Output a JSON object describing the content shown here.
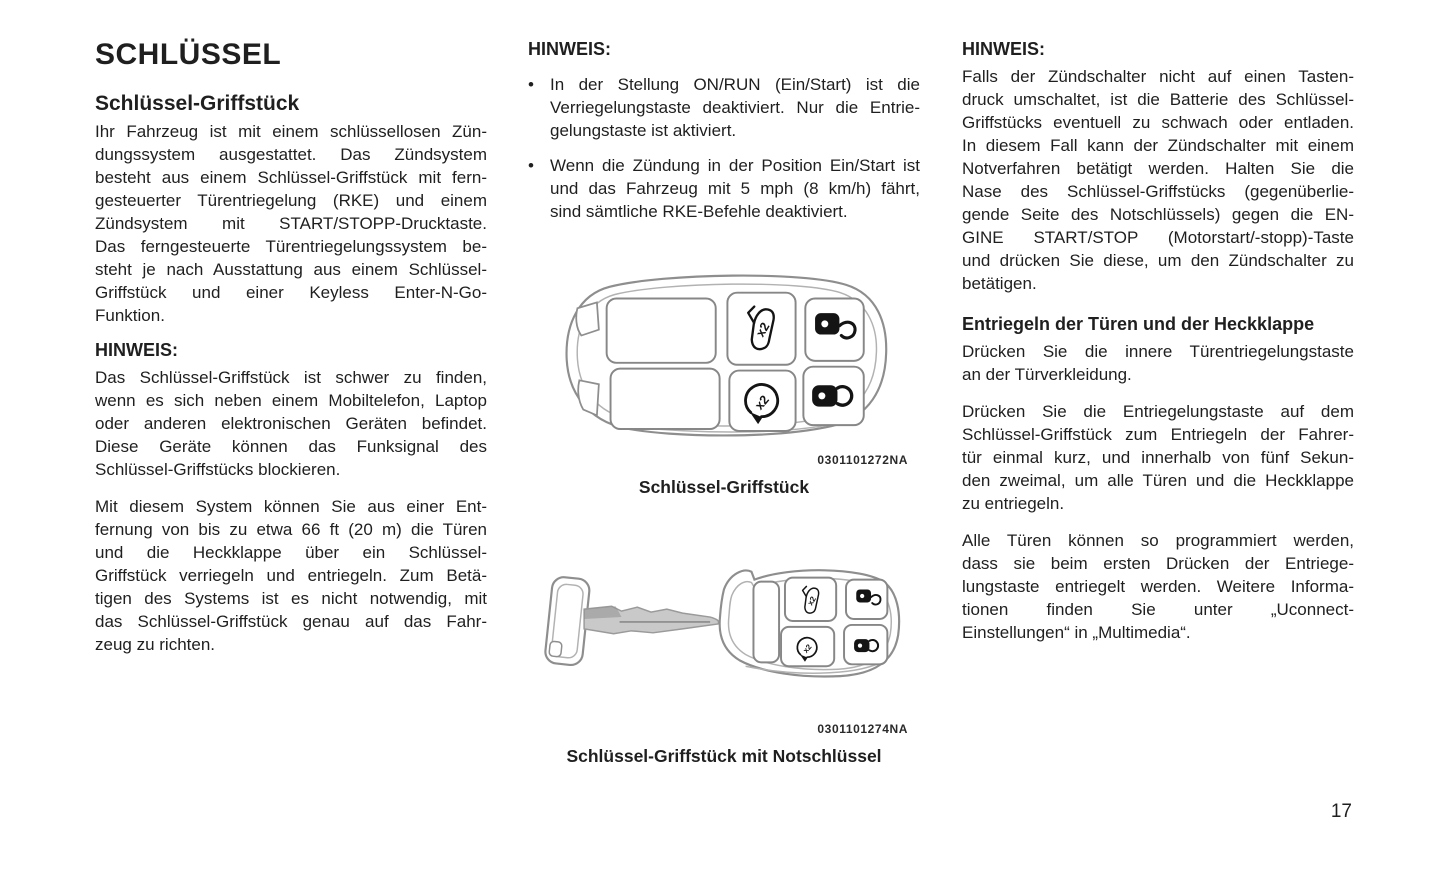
{
  "page": {
    "number": "17"
  },
  "colors": {
    "text": "#1f1f1f",
    "line_art": "#8e8e8e",
    "icon_ink": "#141414",
    "background": "#ffffff"
  },
  "icons": {
    "multipress_label": "x2",
    "fob_button_icons": [
      "liftgate-release-x2-icon",
      "unlock-icon",
      "remote-start-x2-icon",
      "lock-icon"
    ]
  },
  "columns": {
    "left": {
      "title": "SCHLÜSSEL",
      "subtitle": "Schlüssel-Griffstück",
      "intro_lines": [
        "Ihr Fahrzeug ist mit einem schlüssellosen Zün-",
        "dungssystem ausgestattet. Das Zündsystem",
        "besteht aus einem Schlüssel-Griffstück mit fern-",
        "gesteuerter Türentriegelung (RKE) und einem",
        "Zündsystem mit START/STOPP-Drucktaste.",
        "Das ferngesteuerte Türentriegelungssystem be-",
        "steht je nach Ausstattung aus einem Schlüssel-",
        "Griffstück und einer Keyless Enter-N-Go-",
        "Funktion."
      ],
      "hinweis_label": "HINWEIS:",
      "hinweis_lines": [
        "Das Schlüssel-Griffstück ist schwer zu finden,",
        "wenn es sich neben einem Mobiltelefon, Laptop",
        "oder anderen elektronischen Geräten befindet.",
        "Diese Geräte können das Funksignal des",
        "Schlüssel-Griffstücks blockieren."
      ],
      "range_lines": [
        "Mit diesem System können Sie aus einer Ent-",
        "fernung von bis zu etwa 66 ft (20 m) die Türen",
        "und die Heckklappe über ein Schlüssel-",
        "Griffstück verriegeln und entriegeln. Zum Betä-",
        "tigen des Systems ist es nicht notwendig, mit",
        "das Schlüssel-Griffstück genau auf das Fahr-",
        "zeug zu richten."
      ]
    },
    "middle": {
      "hinweis_label": "HINWEIS:",
      "bullet_char": "•",
      "bullets": [
        {
          "lines": [
            "In der Stellung ON/RUN (Ein/Start) ist die",
            "Verriegelungstaste deaktiviert. Nur die Entrie-",
            "gelungstaste ist aktiviert."
          ]
        },
        {
          "lines": [
            "Wenn die Zündung in der Position Ein/Start ist",
            "und das Fahrzeug mit 5 mph (8 km/h) fährt,",
            "sind sämtliche RKE-Befehle deaktiviert."
          ]
        }
      ],
      "figure1": {
        "code": "0301101272NA",
        "caption": "Schlüssel-Griffstück",
        "buttons": [
          "liftgate-release-x2",
          "unlock",
          "remote-start-x2",
          "lock"
        ]
      },
      "figure2": {
        "code": "0301101274NA",
        "caption": "Schlüssel-Griffstück mit Notschlüssel",
        "buttons": [
          "liftgate-release-x2",
          "unlock",
          "remote-start-x2",
          "lock"
        ]
      }
    },
    "right": {
      "hinweis_label": "HINWEIS:",
      "hinweis_lines": [
        "Falls der Zündschalter nicht auf einen Tasten-",
        "druck umschaltet, ist die Batterie des Schlüssel-",
        "Griffstücks eventuell zu schwach oder entladen.",
        "In diesem Fall kann der Zündschalter mit einem",
        "Notverfahren betätigt werden. Halten Sie die",
        "Nase des Schlüssel-Griffstücks (gegenüberlie-",
        "gende Seite des Notschlüssels) gegen die EN-",
        "GINE START/STOP (Motorstart/-stopp)-Taste",
        "und drücken Sie diese, um den Zündschalter zu",
        "betätigen."
      ],
      "section_heading": "Entriegeln der Türen und der Heckklappe",
      "para1_lines": [
        "Drücken Sie die innere Türentriegelungstaste",
        "an der Türverkleidung."
      ],
      "para2_lines": [
        "Drücken Sie die Entriegelungstaste auf dem",
        "Schlüssel-Griffstück zum Entriegeln der Fahrer-",
        "tür einmal kurz, und innerhalb von fünf Sekun-",
        "den zweimal, um alle Türen und die Heckklappe",
        "zu entriegeln."
      ],
      "para3_lines": [
        "Alle Türen können so programmiert werden,",
        "dass sie beim ersten Drücken der Entriege-",
        "lungstaste entriegelt werden. Weitere Informa-",
        "tionen finden Sie unter „Uconnect-",
        "Einstellungen“ in „Multimedia“."
      ]
    }
  }
}
